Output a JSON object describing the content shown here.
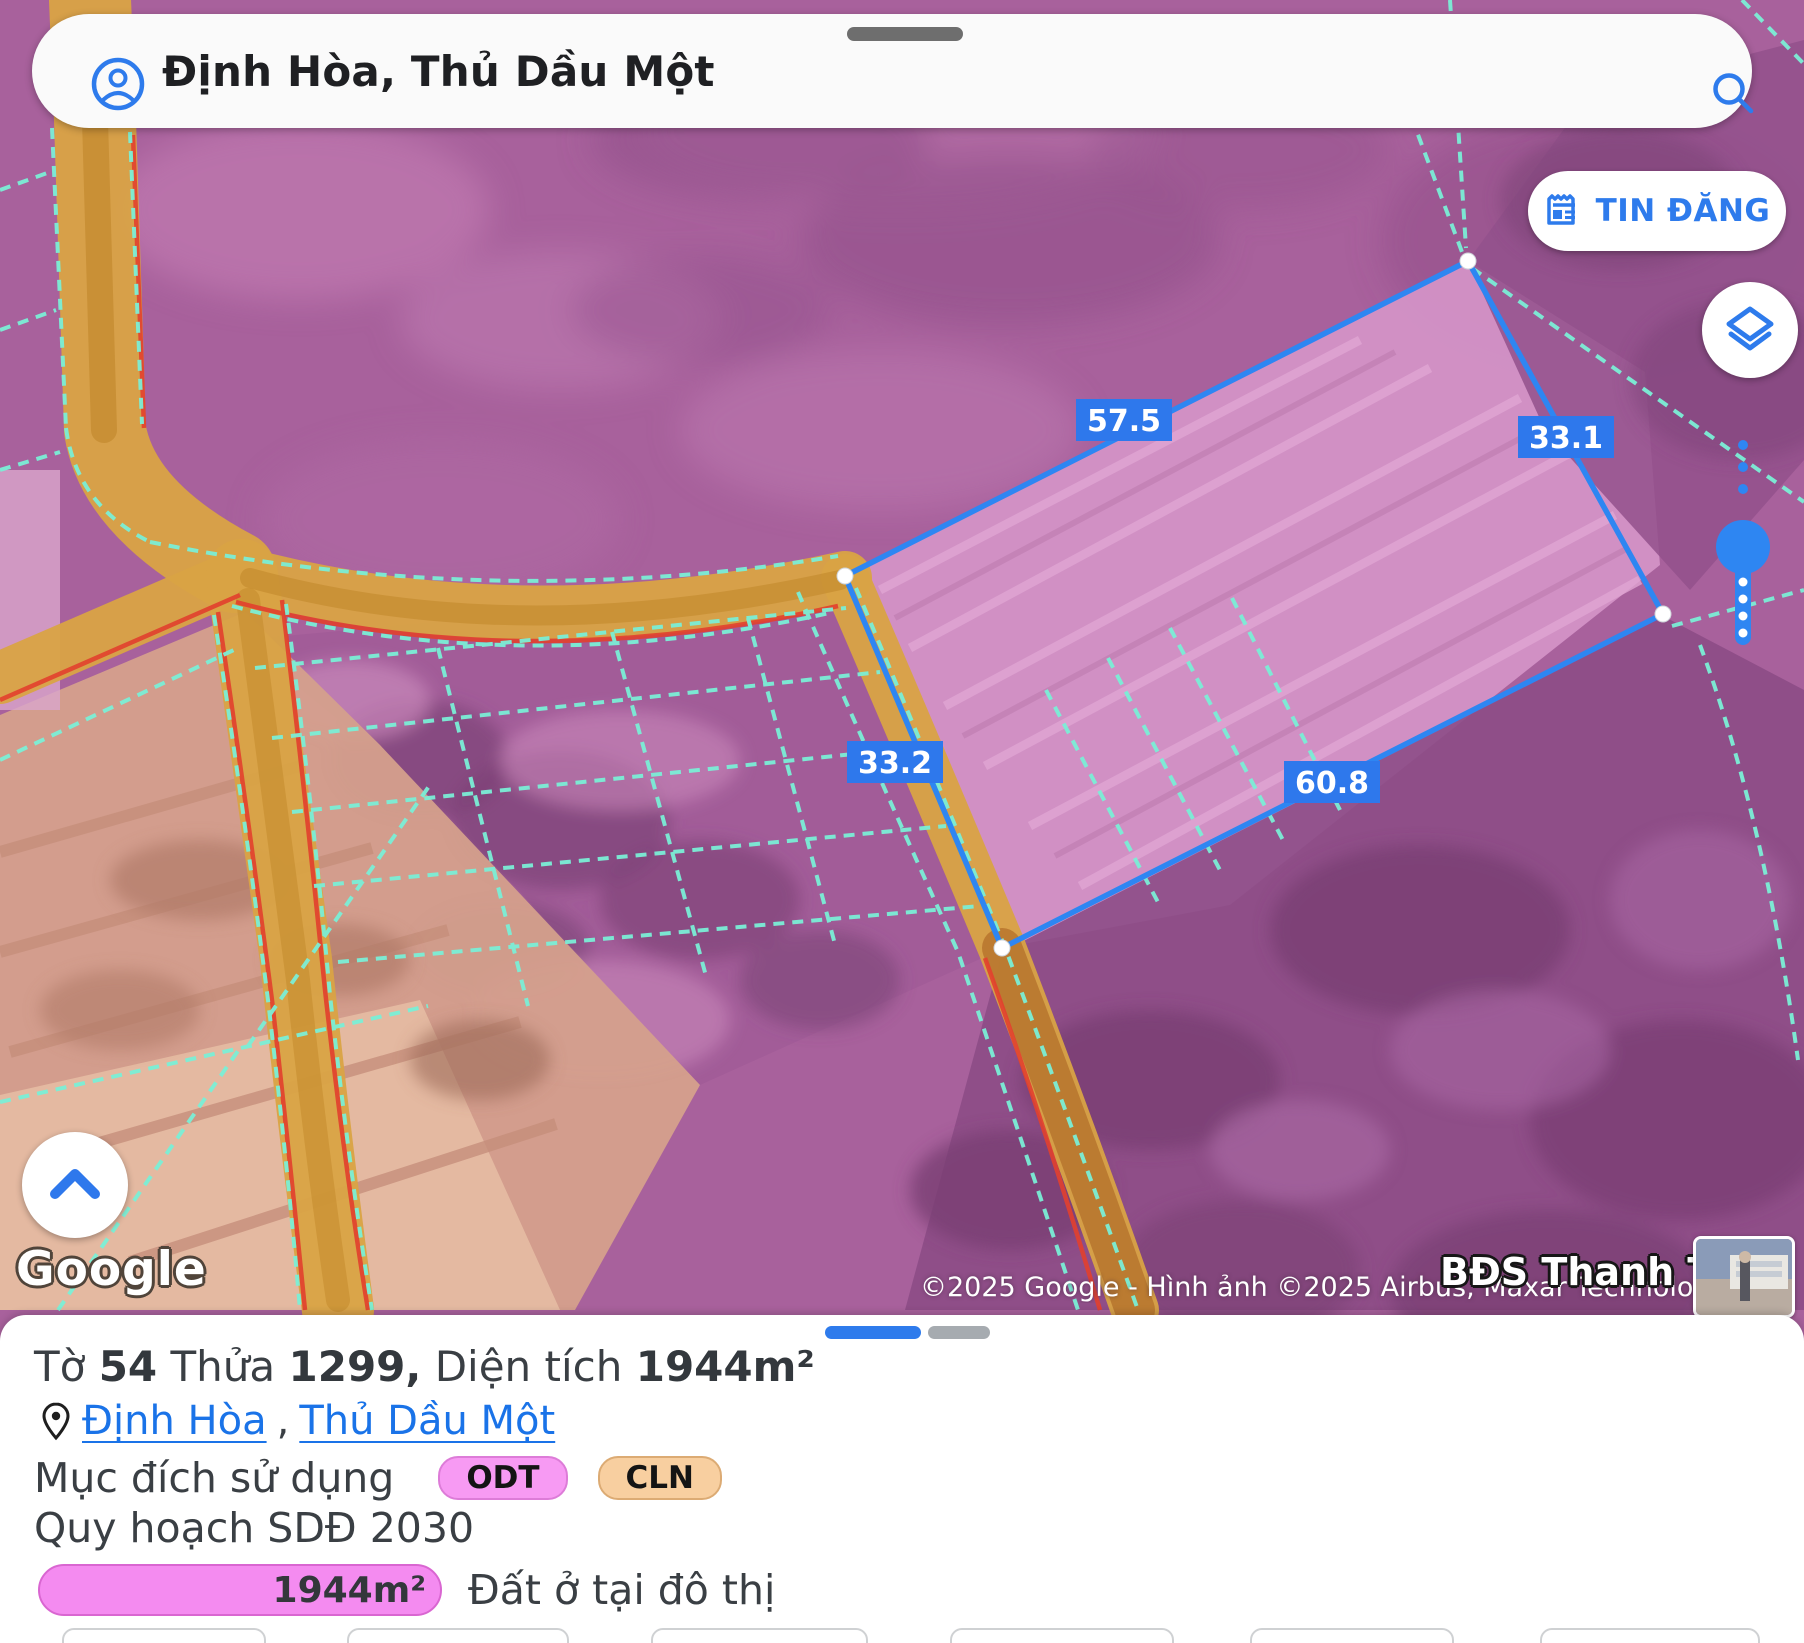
{
  "search": {
    "query": "Định Hòa, Thủ Dầu Một"
  },
  "actions": {
    "tin_dang": "TIN ĐĂNG"
  },
  "map": {
    "measurements": {
      "ab": "57.5",
      "da": "33.1",
      "bc": "33.2",
      "cd": "60.8"
    },
    "google_logo": "Google",
    "attribution": "©2025 Google - Hình ảnh ©2025 Airbus, Maxar Technologies",
    "watermark": "BĐS Thanh Thế"
  },
  "panel": {
    "title": {
      "t1": "Tờ ",
      "n1": "54",
      "t2": " Thửa ",
      "n2": "1299,",
      "t3": " Diện tích ",
      "n3": "1944m²"
    },
    "location": {
      "ward": "Định Hòa",
      "separator": ",",
      "city": "Thủ Dầu Một"
    },
    "land_use": {
      "label": "Mục đích sử dụng",
      "codes": [
        {
          "code": "ODT"
        },
        {
          "code": "CLN"
        }
      ]
    },
    "planning": {
      "label": "Quy hoạch SDĐ 2030",
      "rows": [
        {
          "area": "1944m²",
          "name": "Đất ở tại đô thị"
        }
      ]
    }
  },
  "colors": {
    "accent_blue": "#2e7bec",
    "measure_line": "#2e86f2",
    "odt_badge": "#f79af3",
    "cln_badge": "#f8cfa0",
    "planning_bar": "#f48bf0",
    "road_tan": "#d9a344",
    "parcel_line_teal": "#7befd6",
    "overlay_purple": "#a8619c"
  }
}
